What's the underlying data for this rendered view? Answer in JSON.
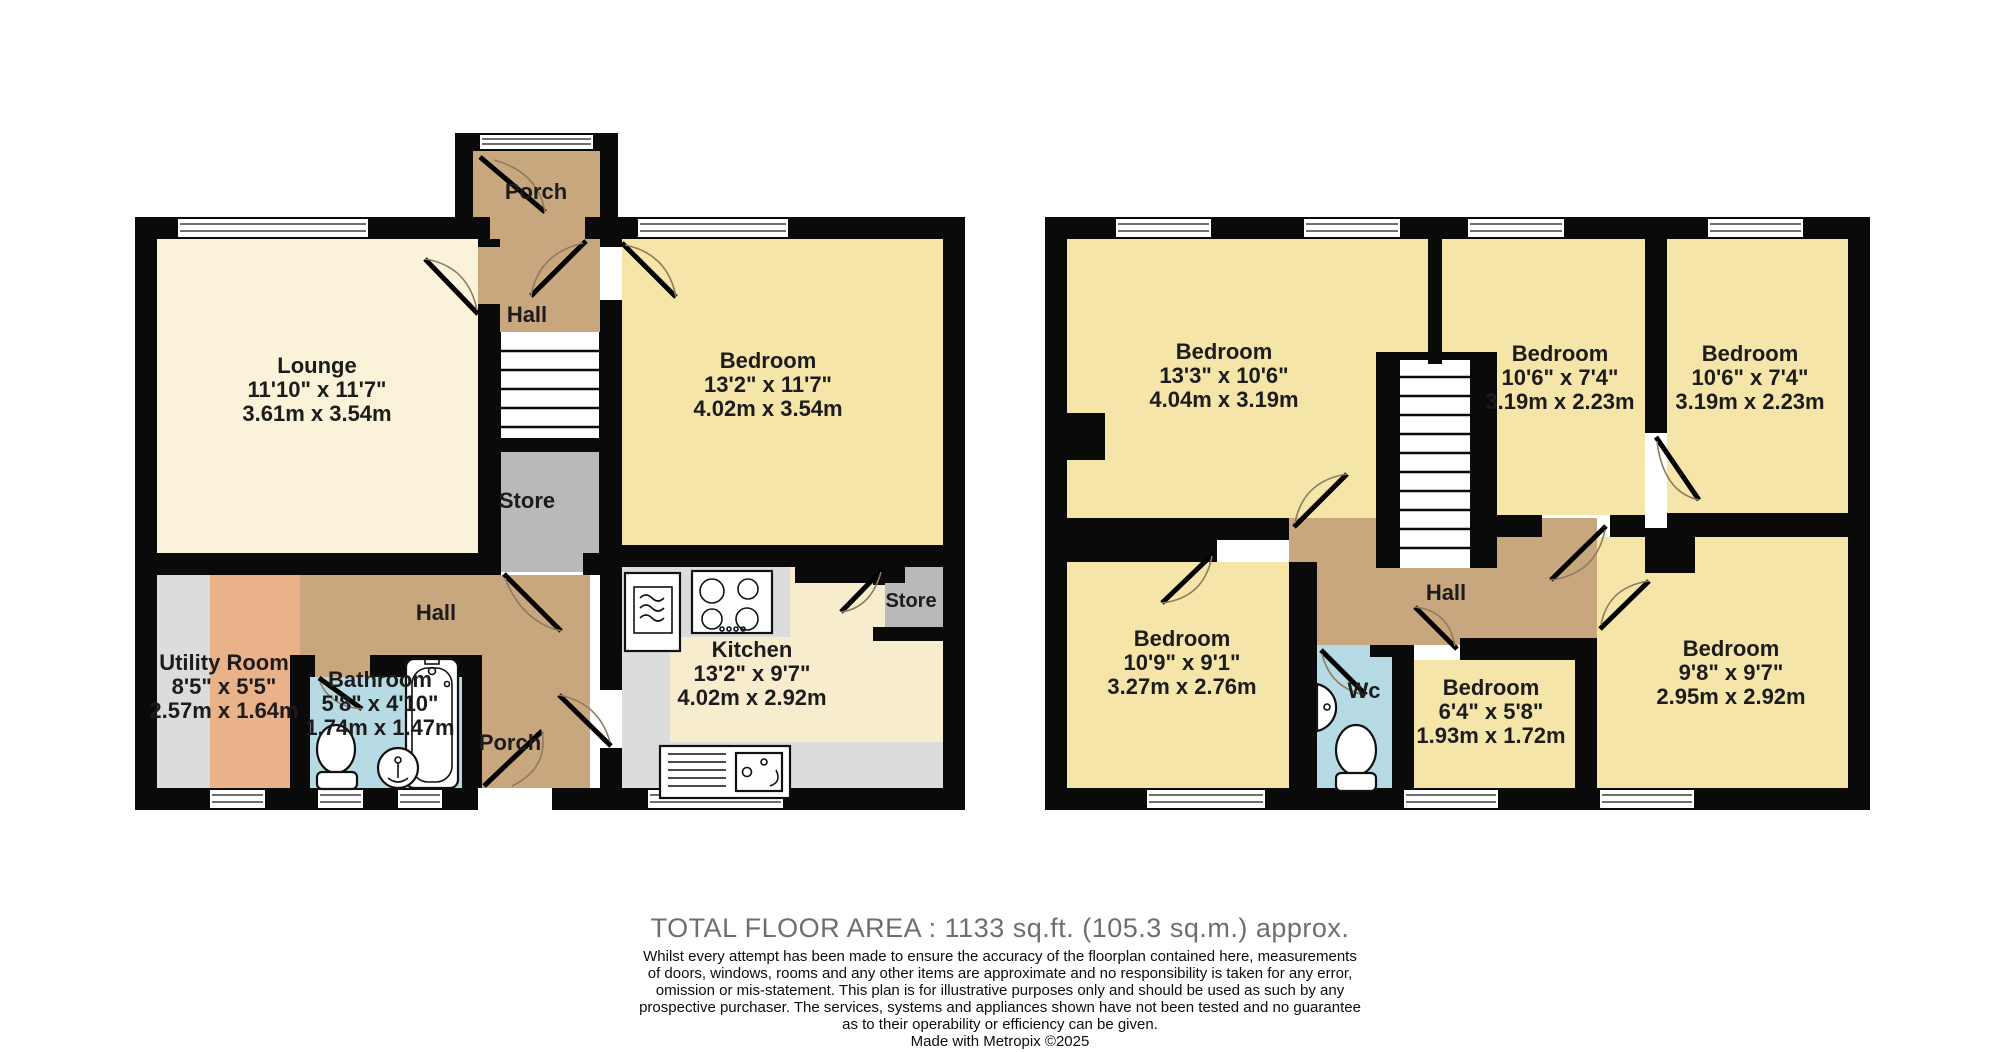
{
  "palette": {
    "wall": "#0a0a0a",
    "lounge_cream": "#faf3d9",
    "bedroom_yellow": "#f6e5a9",
    "hall_brown": "#c8a77f",
    "utility_orange": "#e9b288",
    "counter_gray": "#dcdcdc",
    "store_gray": "#b9b9b9",
    "bath_blue": "#b7dbe4",
    "kitchen_cream": "#f7eccd",
    "title_gray": "#6e6e6e"
  },
  "ground_floor": {
    "porch_top": {
      "name": "Porch"
    },
    "hall_upper": {
      "name": "Hall"
    },
    "lounge": {
      "name": "Lounge",
      "imperial": "11'10\" x 11'7\"",
      "metric": "3.61m x 3.54m"
    },
    "bedroom": {
      "name": "Bedroom",
      "imperial": "13'2\" x 11'7\"",
      "metric": "4.02m x 3.54m"
    },
    "store_stairs": {
      "name": "Store"
    },
    "utility": {
      "name": "Utility Room",
      "imperial": "8'5\" x 5'5\"",
      "metric": "2.57m x 1.64m"
    },
    "bathroom": {
      "name": "Bathroom",
      "imperial": "5'8\" x 4'10\"",
      "metric": "1.74m x 1.47m"
    },
    "hall_lower": {
      "name": "Hall"
    },
    "porch_lower": {
      "name": "Porch"
    },
    "kitchen": {
      "name": "Kitchen",
      "imperial": "13'2\" x 9'7\"",
      "metric": "4.02m x 2.92m"
    },
    "store_kitchen": {
      "name": "Store"
    }
  },
  "first_floor": {
    "bedroom_top_left": {
      "name": "Bedroom",
      "imperial": "13'3\" x 10'6\"",
      "metric": "4.04m x 3.19m"
    },
    "bedroom_top_middle": {
      "name": "Bedroom",
      "imperial": "10'6\" x 7'4\"",
      "metric": "3.19m x 2.23m"
    },
    "bedroom_top_right": {
      "name": "Bedroom",
      "imperial": "10'6\" x 7'4\"",
      "metric": "3.19m x 2.23m"
    },
    "hall": {
      "name": "Hall"
    },
    "bedroom_bottom_left": {
      "name": "Bedroom",
      "imperial": "10'9\" x 9'1\"",
      "metric": "3.27m x 2.76m"
    },
    "wc": {
      "name": "Wc"
    },
    "bedroom_small": {
      "name": "Bedroom",
      "imperial": "6'4\" x 5'8\"",
      "metric": "1.93m x 1.72m"
    },
    "bedroom_bottom_right": {
      "name": "Bedroom",
      "imperial": "9'8\" x 9'7\"",
      "metric": "2.95m x 2.92m"
    }
  },
  "footer": {
    "total_area": "TOTAL FLOOR AREA : 1133 sq.ft. (105.3 sq.m.) approx.",
    "disclaimer_lines": [
      "Whilst every attempt has been made to ensure the accuracy of the floorplan contained here, measurements",
      "of doors, windows, rooms and any other items are approximate and no responsibility is taken for any error,",
      "omission or mis-statement. This plan is for illustrative purposes only and should be used as such by any",
      "prospective purchaser. The services, systems and appliances shown have not been tested and no guarantee",
      "as to their operability or efficiency can be given."
    ],
    "credit": "Made with Metropix ©2025"
  }
}
